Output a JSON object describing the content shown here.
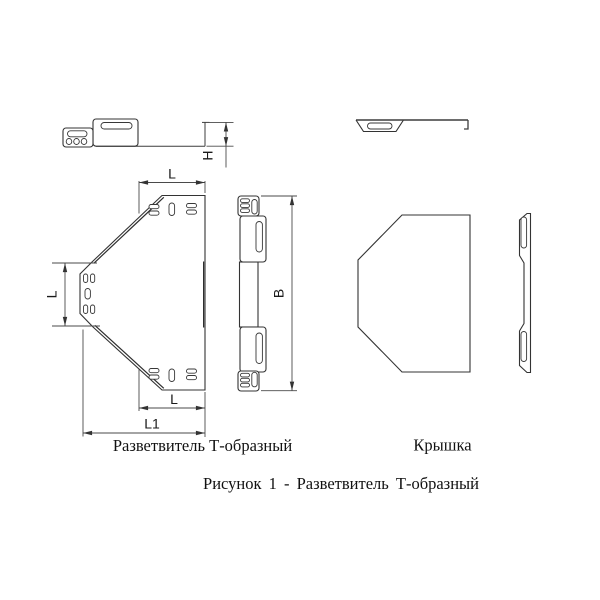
{
  "figure": {
    "part_label_splitter": "Разветвитель Т-образный",
    "part_label_cover": "Крышка",
    "caption": "Рисунок 1 - Разветвитель Т-образный"
  },
  "dimension_labels": {
    "h": "H",
    "l_top": "L",
    "l_branch": "L",
    "l_bottom": "L",
    "l1": "L1",
    "b": "B"
  },
  "colors": {
    "line": "#333333",
    "background": "#ffffff"
  }
}
